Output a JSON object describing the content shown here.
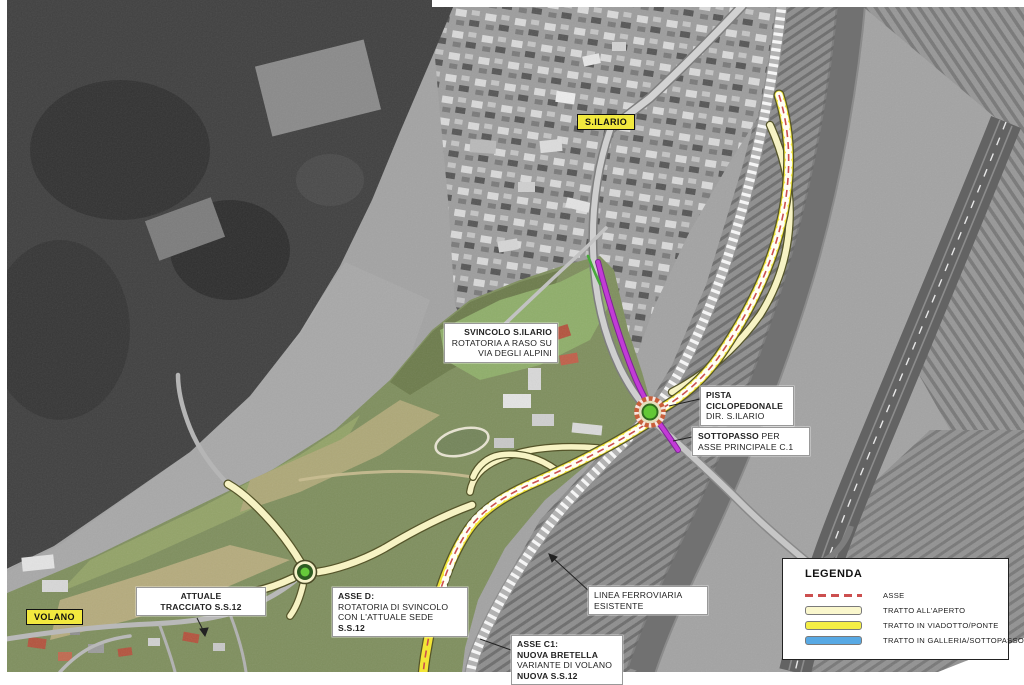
{
  "map": {
    "place_labels": {
      "silario": "S.ILARIO",
      "volano": "VOLANO"
    },
    "callouts": {
      "svincolo": {
        "line1": "SVINCOLO S.ILARIO",
        "line2": "ROTATORIA A RASO SU",
        "line3": "VIA DEGLI ALPINI"
      },
      "pista": {
        "line1": "PISTA",
        "line2": "CICLOPEDONALE",
        "line3": "DIR. S.ILARIO"
      },
      "sottopasso": {
        "line1_bold": "SOTTOPASSO",
        "line1_rest": " PER",
        "line2": "ASSE PRINCIPALE C.1"
      },
      "attuale": {
        "line1": "ATTUALE",
        "line2": "TRACCIATO S.S.12"
      },
      "asse_d": {
        "line1": "ASSE D:",
        "line2": "ROTATORIA DI SVINCOLO",
        "line3_prefix": "CON L'ATTUALE SEDE ",
        "line3_bold": "S.S.12"
      },
      "linea_ferroviaria": {
        "line1": "LINEA FERROVIARIA",
        "line2": "ESISTENTE"
      },
      "asse_c1": {
        "line1": "ASSE C1:",
        "line2": "NUOVA BRETELLA",
        "line3": "VARIANTE DI VOLANO",
        "line4": "NUOVA S.S.12"
      }
    },
    "legend": {
      "title": "LEGENDA",
      "items": [
        {
          "label": "ASSE",
          "swatch": "dashed-line",
          "color": "#cc4f4f"
        },
        {
          "label": "TRATTO ALL'APERTO",
          "swatch": "box",
          "color": "#faf7cd"
        },
        {
          "label": "TRATTO IN VIADOTTO/PONTE",
          "swatch": "box",
          "color": "#f4ee45"
        },
        {
          "label": "TRATTO IN GALLERIA/SOTTOPASSO",
          "swatch": "box",
          "color": "#58a9e4"
        }
      ]
    },
    "colors": {
      "axis_red": "#cc4f4f",
      "open_stretch_yellow": "#f7f3c4",
      "viaduct_yellow": "#f2e636",
      "underpass_blue": "#58a9e4",
      "cycle_path_magenta": "#c23bd6",
      "place_tag_yellow": "#f2e93e",
      "roundabout_green": "#63c736"
    }
  }
}
